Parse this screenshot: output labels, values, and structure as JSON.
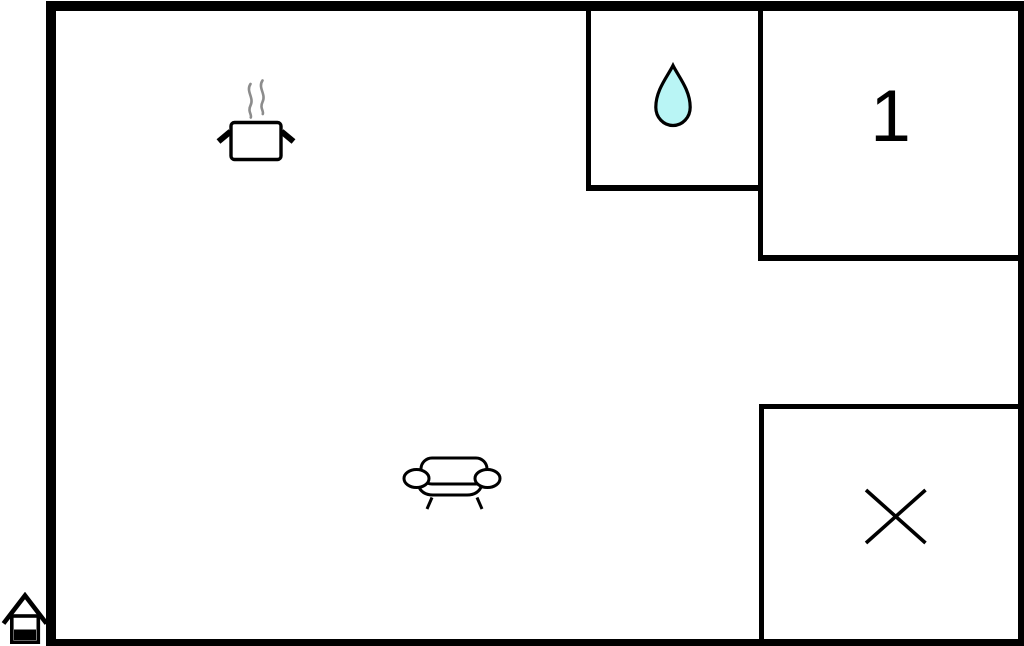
{
  "floor_plan": {
    "type": "holiday-home-floor-plan",
    "bedroom_1": {
      "label": "1"
    },
    "icons": {
      "kitchen": "cooking-pot-icon",
      "bathroom": "water-drop-icon",
      "living_room": "sofa-icon",
      "closed_area": "x-mark-icon",
      "entrance_marker": "house-icon"
    }
  },
  "colors": {
    "wall": "#000000",
    "background": "#ffffff",
    "water_drop_fill": "#b9f5f5",
    "steam": "#8c8c8c",
    "icon_stroke": "#000000"
  }
}
